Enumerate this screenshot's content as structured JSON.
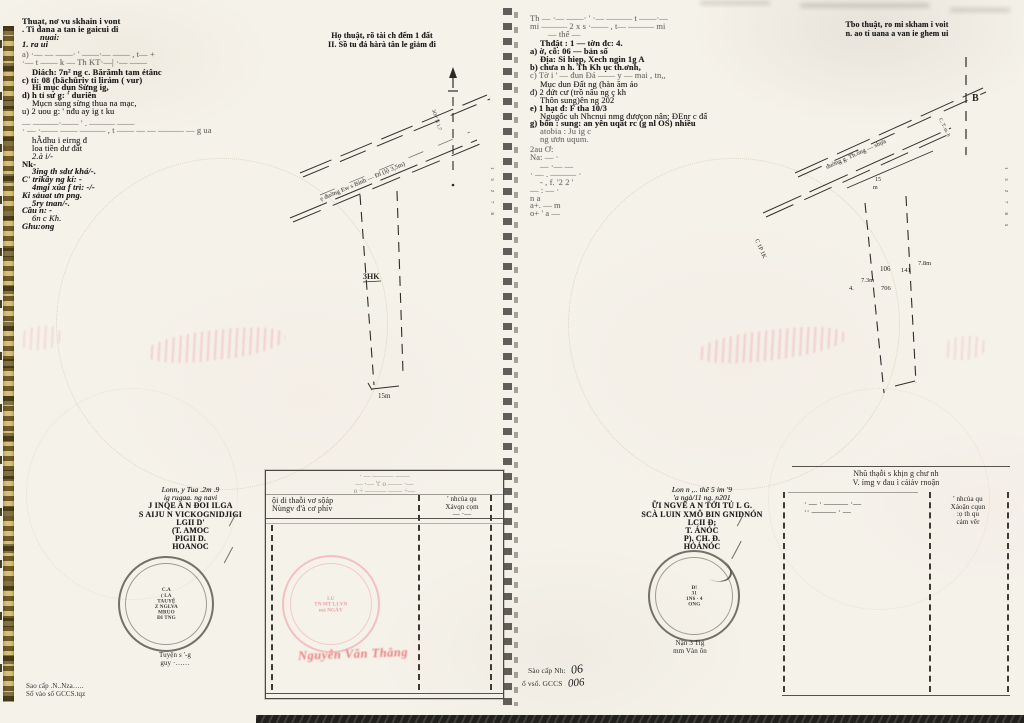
{
  "colors": {
    "page": "#f5f2ea",
    "ink": "#1c1c1c",
    "red_seal": "#ef8080",
    "stamp_dark": "#4a4840",
    "binding_gold": "#d8c078",
    "scan_band": "#21201d"
  },
  "left_page": {
    "col1_lines": [
      {
        "t": "Thuạt, nơ vu skhain i vont",
        "cls": "b"
      },
      {
        "t": ". Ti dana a tan ie gaicui di",
        "cls": "b"
      },
      {
        "t": "nuai:",
        "cls": "bi ind2"
      },
      {
        "t": "1. ra ui",
        "cls": "bi"
      },
      {
        "t": "a) ·— — ——· ' ——·— —— , t— +",
        "cls": "faint g2"
      },
      {
        "t": "·— t —— k — Th KT·—| ·— ——",
        "cls": "faint"
      },
      {
        "t": "Diách:  7n²  ng c. Bărămh tam étânc",
        "cls": "b g2 ind1"
      },
      {
        "t": "c) tí:  08 (bāchūriv ti lirám ( vur)",
        "cls": "b"
      },
      {
        "t": "Hi mục dụn Sừng ig,",
        "cls": "b ind1"
      },
      {
        "t": "d) h tỉ sư g:  ' duriên",
        "cls": "b"
      },
      {
        "t": "Mụcn sùng sừng thua na mạc,",
        "cls": "ind1"
      },
      {
        "t": "u) 2 uou g:  ' nđu ay ig t ku",
        "cls": ""
      },
      {
        "t": "— ———·—— ' . ——— ——",
        "cls": "faint g4"
      },
      {
        "t": "· — ·—— —— ——— , t —— — — ——— — g ua",
        "cls": "faint"
      },
      {
        "t": "hẰdhu i eirng đ",
        "cls": "ind1 g2"
      },
      {
        "t": "loa tiền dư đất",
        "cls": "ind1"
      },
      {
        "t": "2.à i/-",
        "cls": "i ind1"
      },
      {
        "t": "Nk-",
        "cls": "b"
      },
      {
        "t": "3ing th sdư khá/-.",
        "cls": "bi ind1"
      },
      {
        "t": "C' trikây ng kí: -",
        "cls": "bi"
      },
      {
        "t": "4mgi xùa f trì: -/-",
        "cls": "bi ind1"
      },
      {
        "t": "Ki sảuat ưn png.",
        "cls": "bi"
      },
      {
        "t": "5ry tnan/-.",
        "cls": "bi ind1"
      },
      {
        "t": "Cầu n:  -",
        "cls": "bi"
      },
      {
        "t": "6n c Kh.",
        "cls": "i ind1"
      },
      {
        "t": "Ghu:ong",
        "cls": "bi"
      }
    ],
    "heading_lines": [
      {
        "t": "Họ thuật, rõ tài ch đếm 1 đất",
        "cls": ""
      },
      {
        "t": "II. Sồ tu đá hàrà tân le giảm đi",
        "cls": ""
      }
    ],
    "diagram": {
      "road_label": "ẹ đuờng Ew s Bính — Đl (lộ 3,5m)",
      "rotated_label": "3O-ª N 1.7",
      "parcel_label": "3HK",
      "bottom_dim": "15m",
      "ticks": "1  5  2  7  8"
    },
    "sig_lines": [
      {
        "t": "Lonn, y Tua .2m .9",
        "cls": "i"
      },
      {
        "t": "ig rugaa. ng  navi",
        "cls": "i"
      },
      {
        "t": "J INQE A N ĐOI ILGA",
        "cls": "org"
      },
      {
        "t": "S AIJU N VICKOGNIDJIGI",
        "cls": "org"
      },
      {
        "t": "LGII D'",
        "cls": "sm"
      },
      {
        "t": "(T. AMOC",
        "cls": "sm"
      },
      {
        "t": "PIGII D.",
        "cls": "sm"
      },
      {
        "t": "HOANOC",
        "cls": "sm"
      }
    ],
    "stamp_lines": [
      "C.A",
      "( LA",
      "TAUYỆ",
      "Z NGLVA",
      "MRUO",
      "ĐI TNG"
    ],
    "sig_name_lines": [
      "Tuyện s '-g",
      "guy ·……"
    ],
    "footer_lines": [
      "Sao cấp .N..Nza…..",
      "Số vào sổ GCCS.tqz"
    ],
    "table": {
      "title_lines": [
        "· — ——— ——",
        "— ·— 't' o —— ·—",
        "o ÷ ——— —— ÷—"
      ],
      "col1_lines": [
        "ội di thaỗi vơ sộáp",
        "Nùngv đ'à cơ phív"
      ],
      "col2_lines": [
        "' nhcủa qu",
        "Xávqn  cọm",
        "— ·—"
      ],
      "red_stamp_lines": [
        "LU",
        "TN MT LI.VN",
        "mà NGÀY"
      ],
      "red_name": "Nguyễn Văn Thắng"
    }
  },
  "right_page": {
    "col1_lines": [
      {
        "t": "Th — ·— ——· ' ·— ——— t ——·—",
        "cls": "faint"
      },
      {
        "t": "mi ——— 2 x s ·—— , t— ——— mi",
        "cls": "faint"
      },
      {
        "t": "— thế —",
        "cls": "faint ind2"
      },
      {
        "t": "Thđật :   1    — tờn đc:      4.",
        "cls": "b g2 ind1"
      },
      {
        "t": "a) ờ, cỗ:  06 — bản số",
        "cls": "b"
      },
      {
        "t": "Địa:  Si hiẹp, Xech ngin 1g A",
        "cls": "b ind1"
      },
      {
        "t": "b) chưa n h. Th Kh ục th.ơnh,",
        "cls": "b"
      },
      {
        "t": "c) Tờ i ' — đun Đá —— y — mai , tn,,",
        "cls": "faint"
      },
      {
        "t": "Mục dun Đất ng (hàn ăm áo",
        "cls": "g2 ind1"
      },
      {
        "t": "đ) 2 đứt cư  (trồ nâu ng ç kh",
        "cls": ""
      },
      {
        "t": "Thôn sung)ên ng 202",
        "cls": "ind1"
      },
      {
        "t": "e)  1 hạt đ:   F tha 10/3",
        "cls": "b"
      },
      {
        "t": "Ngugốc uh Nhcnui nmg đượçon nân; ĐEnr c đấ",
        "cls": "ind1"
      },
      {
        "t": "g) bôn : sung: an yên uqất rc (g nl OS) nhiều",
        "cls": "b"
      },
      {
        "t": "atobia : Ju ig c",
        "cls": "faint ind1"
      },
      {
        "t": "ng ươn uqum.",
        "cls": "faint ind1"
      },
      {
        "t": "2au Ơ:",
        "cls": "faint g2"
      },
      {
        "t": "Na:  — ·",
        "cls": "faint"
      },
      {
        "t": "— ·— —",
        "cls": "faint g2 ind1"
      },
      {
        "t": "· — . ——— ·",
        "cls": "faint"
      },
      {
        "t": "- , f. '2  2 '",
        "cls": "faint ind1"
      },
      {
        "t": "— : — ·",
        "cls": "faint"
      },
      {
        "t": "n a",
        "cls": "faint"
      },
      {
        "t": "a+. — m",
        "cls": "faint"
      },
      {
        "t": "o+ ' a —",
        "cls": "faint"
      }
    ],
    "heading_lines": [
      {
        "t": "Tbo thuật, ro mi skham i voit",
        "cls": ""
      },
      {
        "t": "n. ao tí uana a van ie ghem ui",
        "cls": ""
      }
    ],
    "diagram": {
      "compass": "B",
      "road_label": "đuờng g. Th.ống — shựa",
      "left_label": "C 1P 1K",
      "rotated_label": "C. T. m. h",
      "dim_a": "15",
      "dim_b": "m",
      "n1": "106",
      "n2": "141",
      "n3": "7.8m",
      "n4": "7.3m",
      "n5": "4.",
      "n6": "706",
      "ticks": "1  5  2  7  8  5"
    },
    "sig_lines": [
      {
        "t": "Lon n ,.. thê 5 im '9",
        "cls": "i"
      },
      {
        "t": "'a ngà/11 ng. n201",
        "cls": "i"
      },
      {
        "t": "ỮI NGVÊ A N TỚI TỦ L G.",
        "cls": "org"
      },
      {
        "t": "SCÀ LUIN XMÔ BIN GNIDNÓN",
        "cls": "org"
      },
      {
        "t": "LCII Đ;",
        "cls": "sm"
      },
      {
        "t": "T. ÁNÓC",
        "cls": "sm"
      },
      {
        "t": "P). CH. Đ.",
        "cls": "sm"
      },
      {
        "t": "HỎÁNÓC",
        "cls": "sm"
      }
    ],
    "stamp_lines": [
      "Đ!",
      "31",
      "1N6 - 4",
      "ONG"
    ],
    "sig_name_lines": [
      "Nận 3 Tig",
      "mm Vàn ôn"
    ],
    "footer": {
      "l1": "Sào cấp Nh:",
      "h1": "06",
      "l2": "ổ vsổ. GCCS",
      "h2": "006"
    },
    "table": {
      "title_lines": [
        "Nhũ thạỗi s khịn g chư nh",
        "V. ỉmg v đau ì cảiảv rnoận"
      ],
      "col1_lines": [
        "· — · ——— ·—",
        "·· ——— · —"
      ],
      "col2_lines": [
        "' nhcủa qu",
        "Xáoận  cqun",
        ":ọ th qu",
        "cảm vêr"
      ]
    }
  }
}
